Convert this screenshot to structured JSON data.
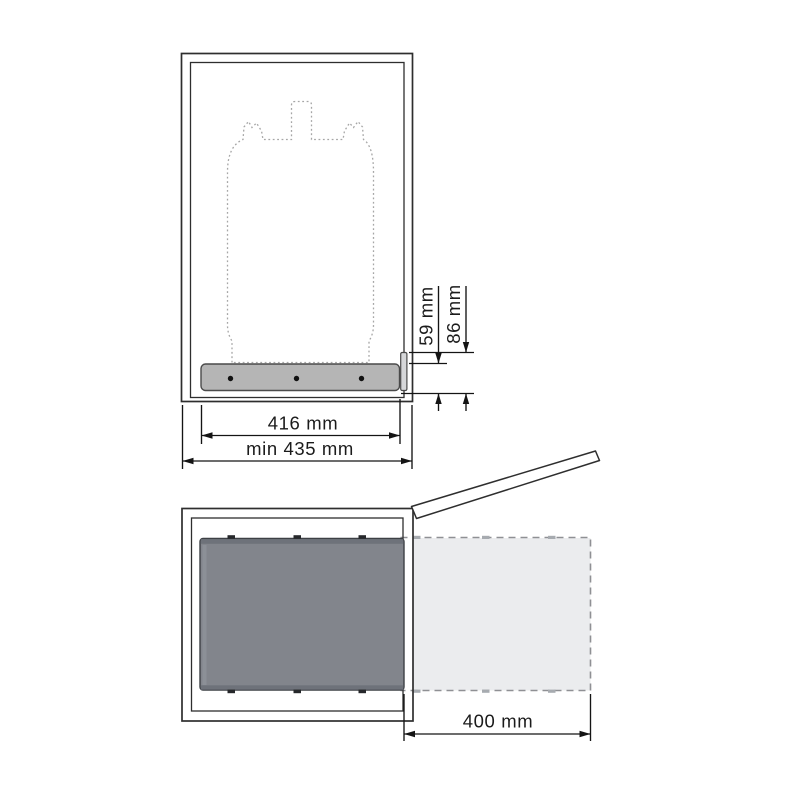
{
  "front_view": {
    "label": "cabinet front view with gas bottle on pull-out rail",
    "dims": {
      "rail_height": "59 mm",
      "bracket_height": "86 mm",
      "rail_width": "416 mm",
      "cabinet_min_width": "min 435 mm"
    }
  },
  "plan_view": {
    "label": "cabinet top view with pull-out platform extended and door open",
    "dims": {
      "extension": "400 mm"
    }
  },
  "colors": {
    "rail_fill": "#b5b5b5",
    "bracket_fill": "#d6d7d9",
    "drawer_fill": "#82858c",
    "drawer_band": "#6e727a",
    "ghost_fill": "#ebecee",
    "tab_dark": "#26282b",
    "tab_gray": "#a7abb0"
  }
}
